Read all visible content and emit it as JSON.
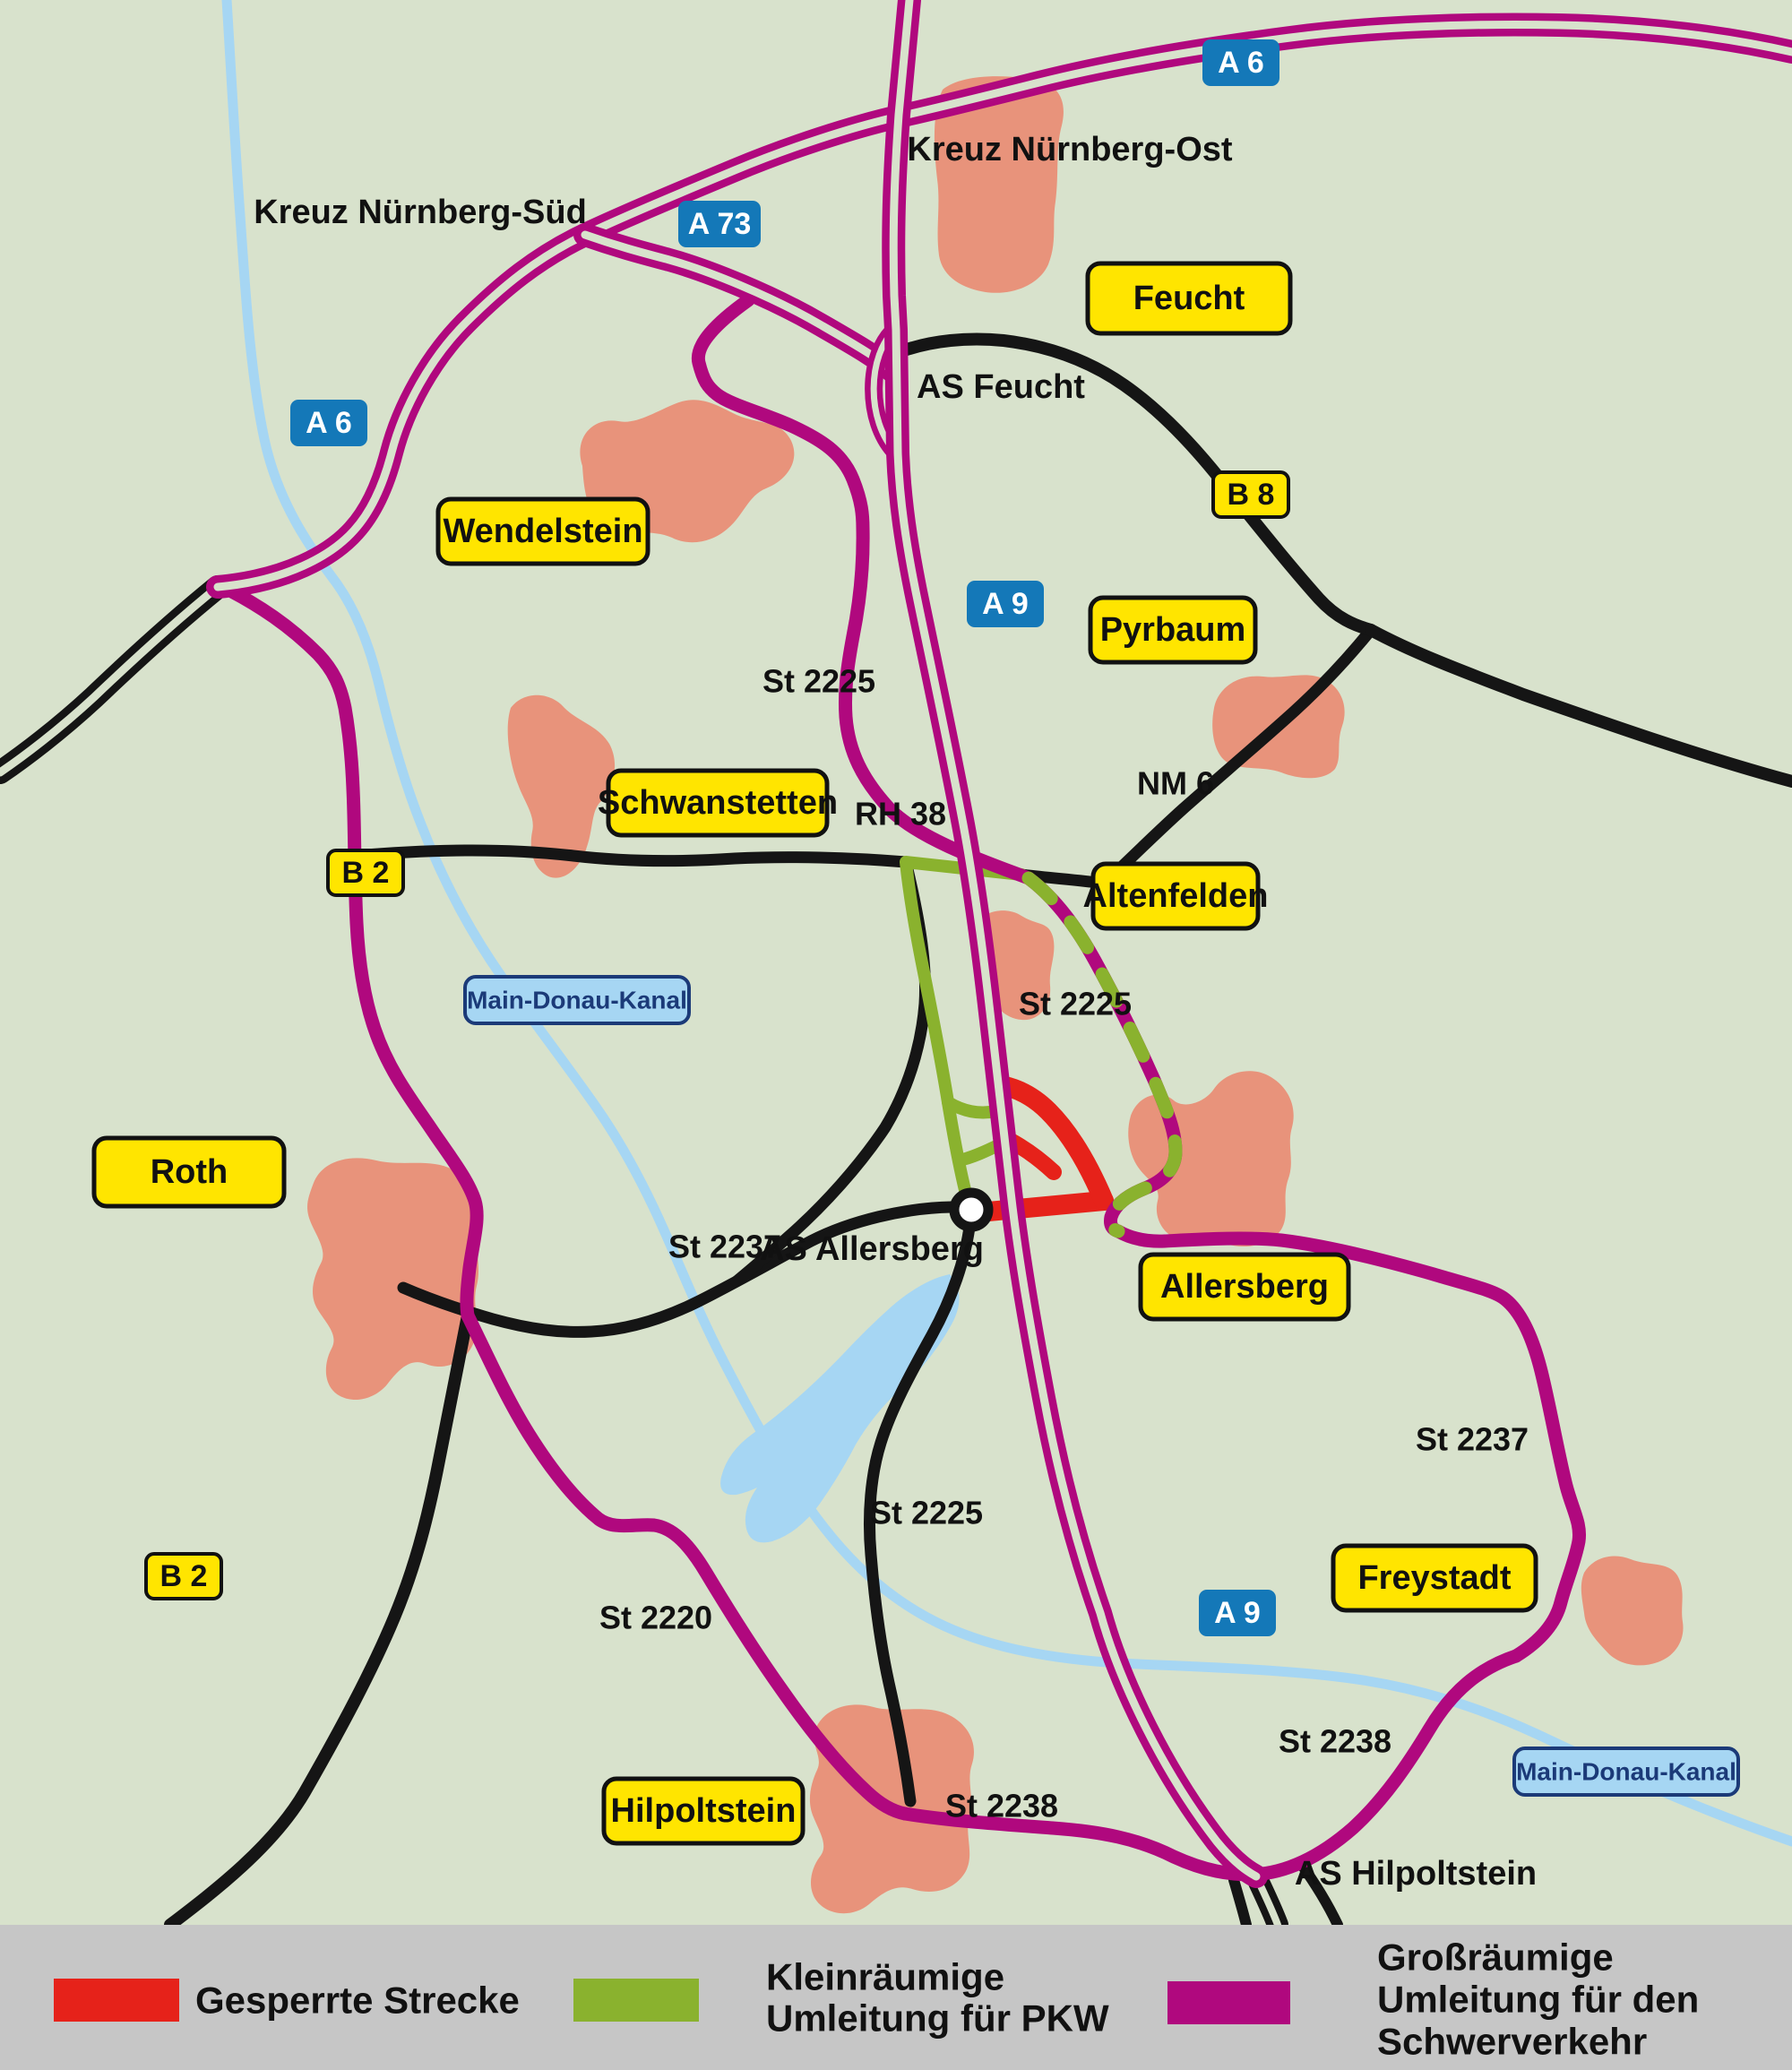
{
  "map": {
    "colors": {
      "background": "#d8e2cc",
      "built_up": "#e8937b",
      "water": "#a6d6f3",
      "road": "#151515",
      "motorway": "#b0087e",
      "detour_truck": "#b0087e",
      "detour_car": "#8ab22e",
      "closed": "#e6221a",
      "shield_blue": "#1478b8",
      "sign_yellow": "#ffe500",
      "canal_label_fill": "#a6d6f3",
      "canal_label_text": "#1b3a78",
      "legend_bg": "#c6c6c6"
    },
    "towns": [
      {
        "name": "Feucht"
      },
      {
        "name": "Wendelstein"
      },
      {
        "name": "Pyrbaum"
      },
      {
        "name": "Schwanstetten"
      },
      {
        "name": "Altenfelden"
      },
      {
        "name": "Roth"
      },
      {
        "name": "Allersberg"
      },
      {
        "name": "Freystadt"
      },
      {
        "name": "Hilpoltstein"
      }
    ],
    "motorway_shields": [
      {
        "label": "A 6"
      },
      {
        "label": "A 73"
      },
      {
        "label": "A 6"
      },
      {
        "label": "A 9"
      },
      {
        "label": "A 9"
      }
    ],
    "road_shields": [
      {
        "label": "B 2"
      },
      {
        "label": "B 2"
      },
      {
        "label": "B 8"
      }
    ],
    "road_labels": [
      {
        "text": "St 2225"
      },
      {
        "text": "RH 38"
      },
      {
        "text": "NM 6"
      },
      {
        "text": "St 2225"
      },
      {
        "text": "St 2237"
      },
      {
        "text": "St 2225"
      },
      {
        "text": "St 2220"
      },
      {
        "text": "St 2237"
      },
      {
        "text": "St 2238"
      },
      {
        "text": "St 2238"
      }
    ],
    "junction_labels": [
      {
        "text": "Kreuz Nürnberg-Ost"
      },
      {
        "text": "Kreuz Nürnberg-Süd"
      },
      {
        "text": "AS Feucht"
      },
      {
        "text": "AS Allersberg"
      },
      {
        "text": "AS Hilpoltstein"
      }
    ],
    "canal_labels": [
      {
        "text": "Main-Donau-Kanal"
      },
      {
        "text": "Main-Donau-Kanal"
      }
    ]
  },
  "legend": {
    "items": [
      {
        "swatch_color": "#e6221a",
        "lines": [
          "Gesperrte Strecke"
        ]
      },
      {
        "swatch_color": "#8ab22e",
        "lines": [
          "Kleinräumige",
          "Umleitung für PKW"
        ]
      },
      {
        "swatch_color": "#b0087e",
        "lines": [
          "Großräumige",
          "Umleitung für den",
          "Schwerverkehr"
        ]
      }
    ]
  }
}
